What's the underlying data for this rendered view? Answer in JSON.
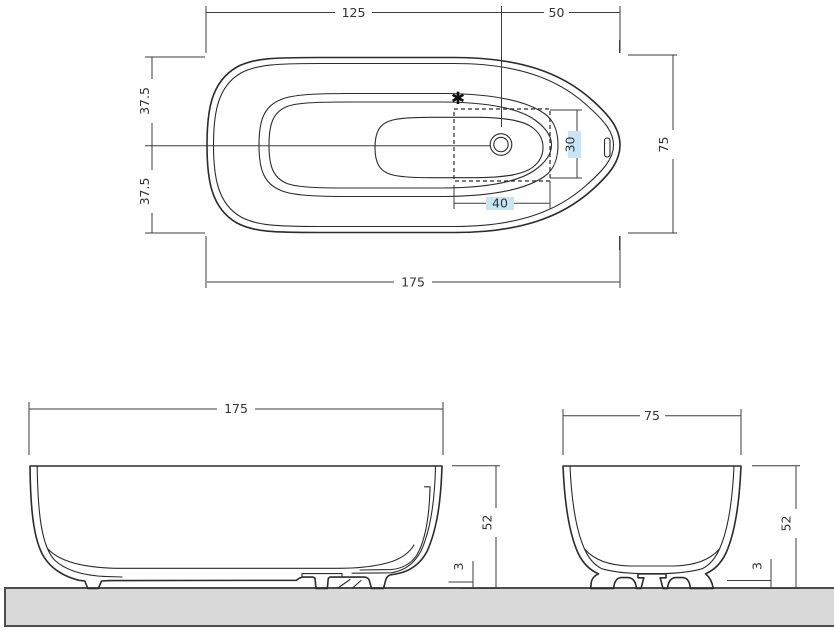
{
  "colors": {
    "tub_fill": "#c6e6f8",
    "outline": "#2b2b2b",
    "dimension_line": "#3d3d3d",
    "floor_fill": "#d9d9d9",
    "floor_edge": "#4d4d4d"
  },
  "plan_view": {
    "dim_left_to_drain": "125",
    "dim_drain_to_right": "50",
    "dim_half_width_top": "37.5",
    "dim_half_width_bottom": "37.5",
    "dim_overall_width": "75",
    "dim_drain_area_width": "30",
    "dim_drain_area_length": "40",
    "dim_overall_length": "175",
    "marker_star": "✱"
  },
  "front_view": {
    "dim_overall_length": "175",
    "dim_height": "52",
    "dim_floor_clearance": "3"
  },
  "side_view": {
    "dim_overall_width": "75",
    "dim_height": "52",
    "dim_floor_clearance": "3"
  }
}
